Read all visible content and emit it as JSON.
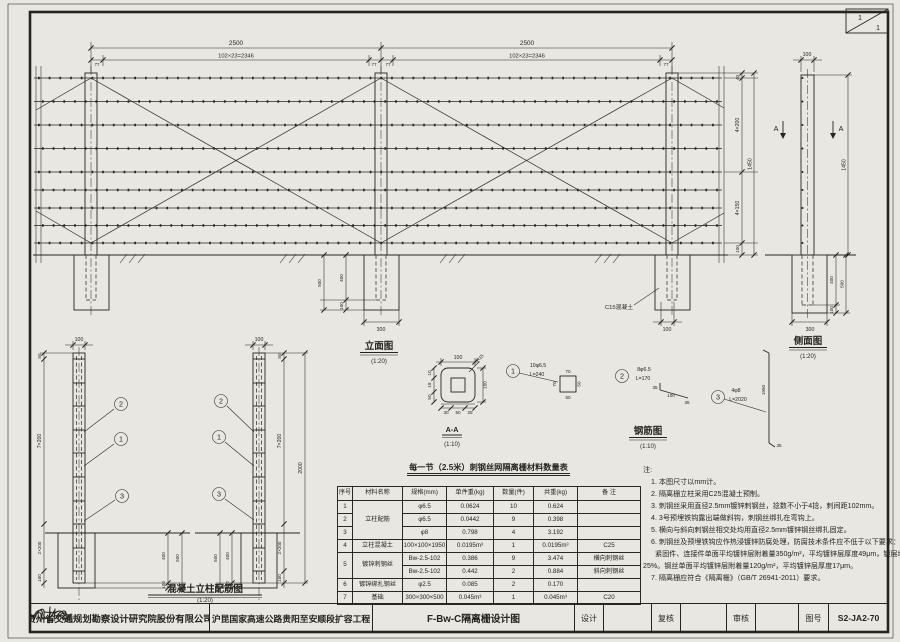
{
  "corner": {
    "sheet_top": "1",
    "sheet_bottom": "1"
  },
  "elev": {
    "title": "立面图",
    "scale": "(1:20)",
    "span": "2500",
    "wires": "102×23=2346",
    "offset": "77",
    "top_gap": "40",
    "upper": "4×200",
    "lower": "4×150",
    "bottom": "100",
    "height": "1450",
    "fpost": "400",
    "fdepth": "500",
    "funder": "100",
    "fwidth": "300",
    "bwidth": "100",
    "c15": "C15混凝土"
  },
  "side": {
    "title": "侧面图",
    "scale": "(1:20)",
    "pw": "100",
    "height": "1450",
    "fpost": "400",
    "fdepth": "500",
    "funder": "100",
    "fwidth": "300",
    "a": "A"
  },
  "detail": {
    "title": "混凝土立柱配筋图",
    "scale": "(1:20)",
    "pw": "100",
    "top": "50",
    "upper": "7×200",
    "buried": "2×200",
    "bottom": "100",
    "total": "2000",
    "fpost": "400",
    "fdepth": "500",
    "funder": "100",
    "c1": "1",
    "c2": "2",
    "c3": "3"
  },
  "aa": {
    "title": "A-A",
    "scale": "(1:10)",
    "w": "100",
    "h": "100",
    "r": "R15",
    "l1": "10",
    "l2": "18",
    "l3": "50",
    "b1": "30",
    "b2": "50",
    "b3": "25"
  },
  "rebar": {
    "title": "钢筋图",
    "scale": "(1:10)",
    "b1": {
      "no": "1",
      "spec": "10φ6.5",
      "len": "L=240",
      "d_top": "70",
      "d_right": "50",
      "d_bottom": "50",
      "d_left": "70"
    },
    "b2": {
      "no": "2",
      "spec": "8φ6.5",
      "len": "L=170",
      "d_a": "35",
      "d_b": "100",
      "d_c": "35"
    },
    "b3": {
      "no": "3",
      "spec": "4φ8",
      "len": "L=2020",
      "d_main": "1950",
      "d_end": "35"
    }
  },
  "table": {
    "title": "每一节（2.5米）刺钢丝网隔离栅材料数量表",
    "headers": [
      "序号",
      "材料名称",
      "规格(mm)",
      "单件重(kg)",
      "数量(件)",
      "共重(kg)",
      "备 注"
    ],
    "rows": [
      [
        "1",
        "立柱配筋",
        "φ6.5",
        "0.0624",
        "10",
        "0.624",
        ""
      ],
      [
        "2",
        "",
        "φ6.5",
        "0.0442",
        "9",
        "0.398",
        ""
      ],
      [
        "3",
        "",
        "φ8",
        "0.798",
        "4",
        "3.192",
        ""
      ],
      [
        "4",
        "立柱混凝土",
        "100×100×1950",
        "0.0195m³",
        "1",
        "0.0195m³",
        "C25"
      ],
      [
        "5",
        "镀锌刺钢丝",
        "Bw-2.5-102",
        "0.386",
        "9",
        "3.474",
        "横向刺钢丝"
      ],
      [
        "",
        "",
        "Bw-2.5-102",
        "0.442",
        "2",
        "0.884",
        "斜向刺钢丝"
      ],
      [
        "6",
        "镀锌绑扎钢丝",
        "φ2.5",
        "0.085",
        "2",
        "0.170",
        ""
      ],
      [
        "7",
        "基础",
        "300×300×500",
        "0.045m³",
        "1",
        "0.045m³",
        "C20"
      ]
    ]
  },
  "notes": {
    "label": "注:",
    "lines": [
      "1. 本图尺寸以mm计。",
      "2. 隔离栅立柱采用C25混凝土预制。",
      "3. 刺钢丝采用直径2.5mm镀锌刺钢丝，捻数不小于4捻，刺间距102mm。",
      "4. 3号预埋铁钩露出端做斜钩，刺钢丝绑扎在弯钩上。",
      "5. 横向与斜向刺钢丝相交处均用直径2.5mm镀锌钢丝绑扎固定。",
      "6. 刺钢丝及预埋铁钩应作热浸镀锌防腐处理，防腐技术条件应不低于以下要求：",
      "紧固件、连接件单面平均镀锌层附着量350g/m²，平均镀锌层厚度49μm，镀层均匀性",
      "25%。钢丝单面平均镀锌层附着量120g/m²，平均镀锌层厚度17μm。",
      "7. 隔离栅应符合《隔离栅》（GB/T 26941-2011）要求。"
    ]
  },
  "titleblock": {
    "company": "贵州省交通规划勘察设计研究院股份有限公司",
    "project": "沪昆国家高速公路贵阳至安顺段扩容工程",
    "drawing_title": "F-Bw-C隔离栅设计图",
    "design_label": "设计",
    "recheck_label": "复核",
    "review_label": "审核",
    "figno_label": "图号",
    "fig_no": "S2-JA2-70"
  }
}
